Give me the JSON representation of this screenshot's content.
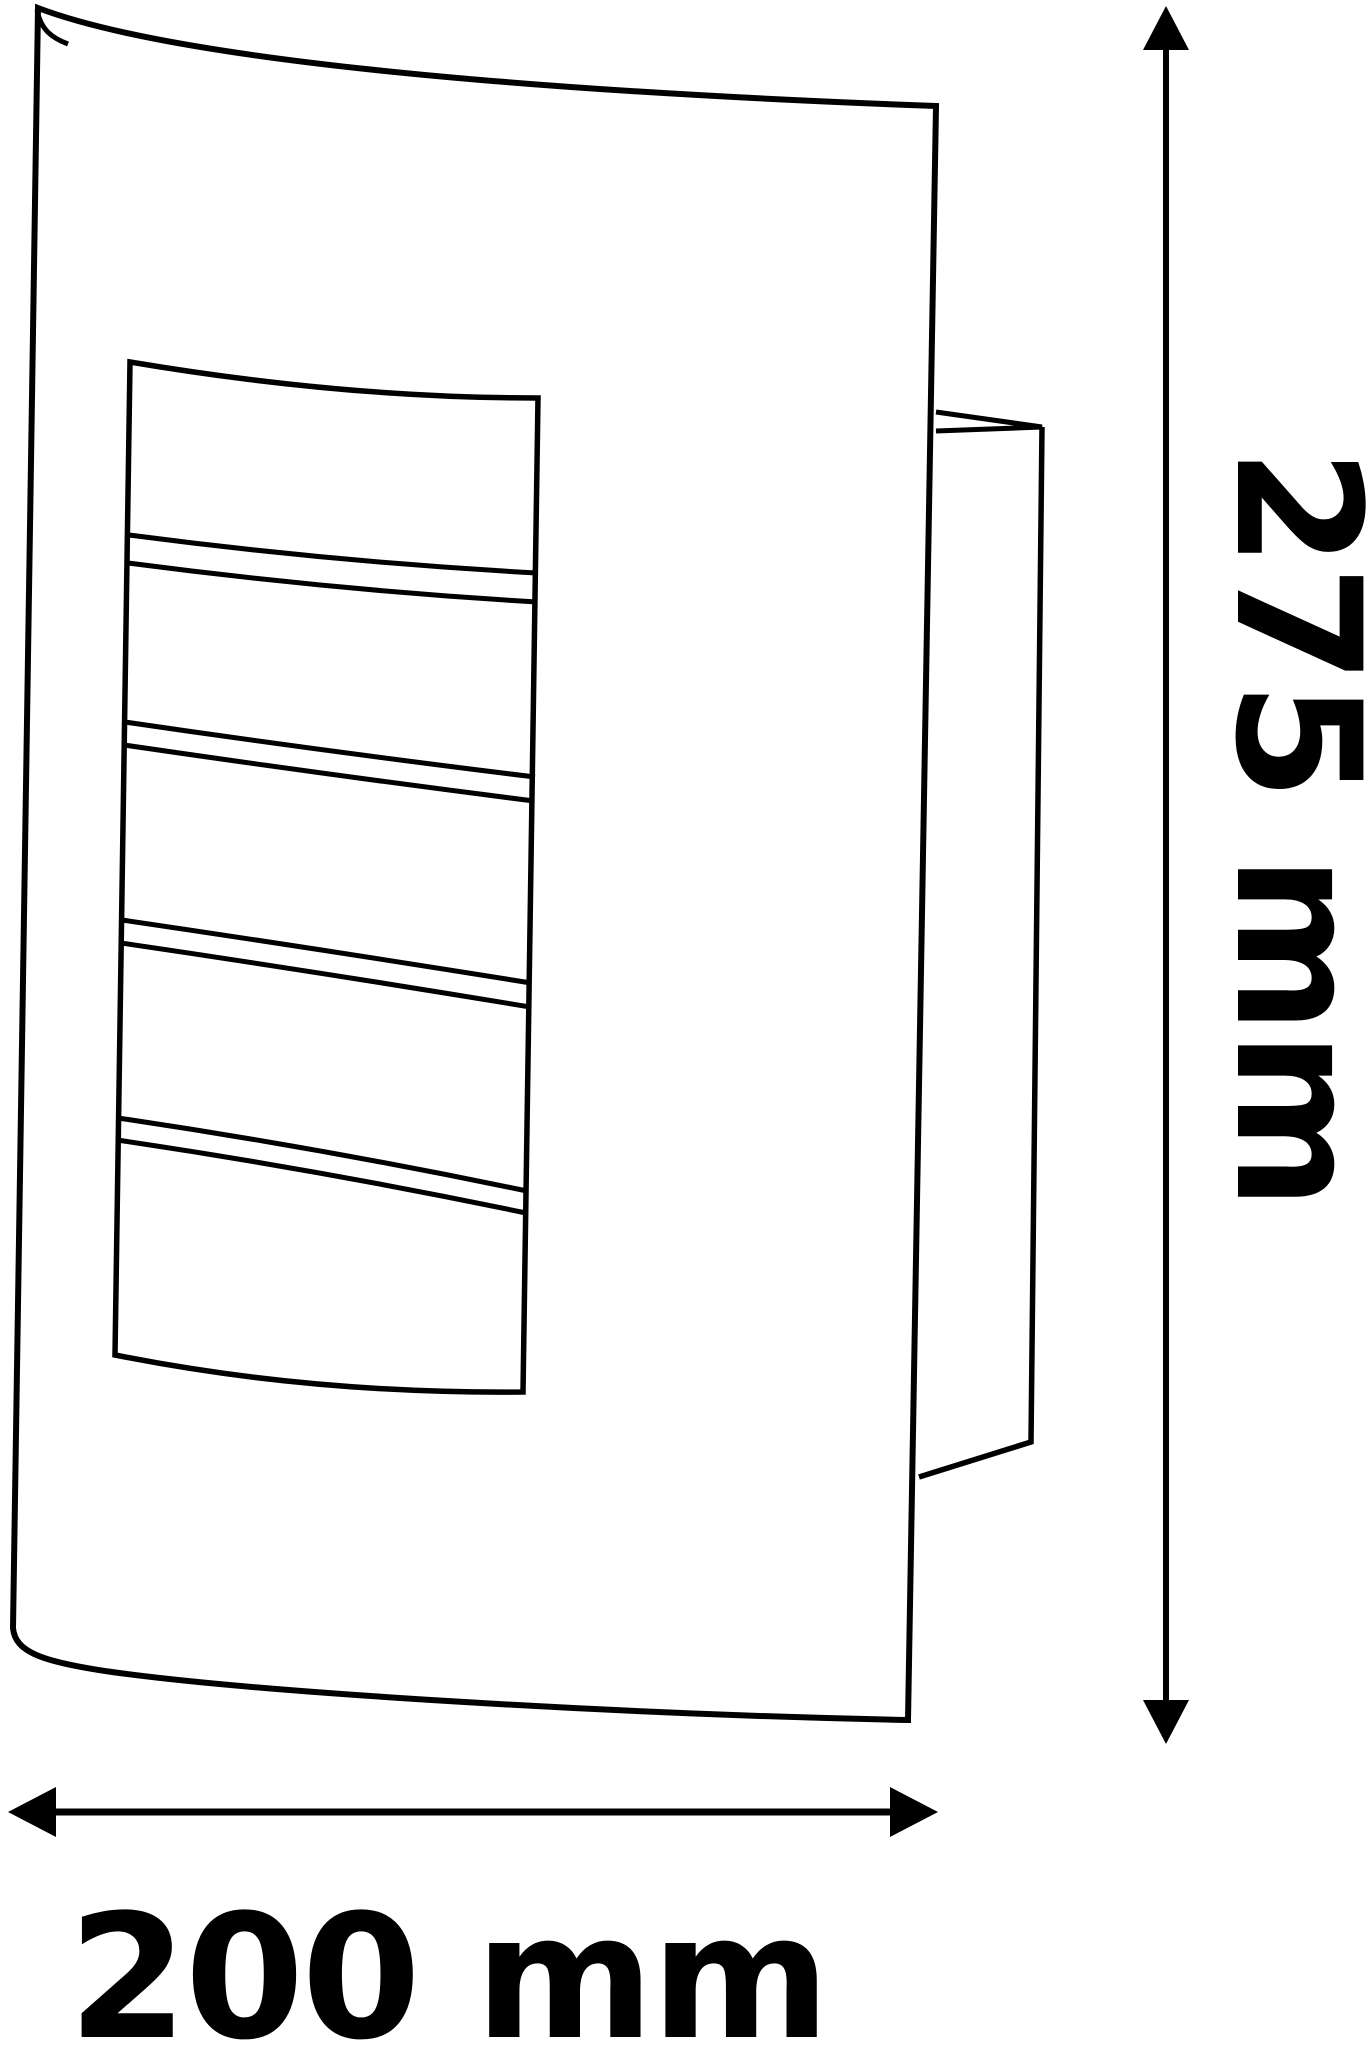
{
  "page": {
    "background": "#ffffff",
    "ink": "#000000"
  },
  "drawing": {
    "subject": "wall-lamp-profile",
    "grille_slat_count": 5
  },
  "dimensions": {
    "height": {
      "value": 275,
      "unit": "mm",
      "label": "275 mm"
    },
    "width": {
      "value": 200,
      "unit": "mm",
      "label": "200 mm"
    }
  }
}
